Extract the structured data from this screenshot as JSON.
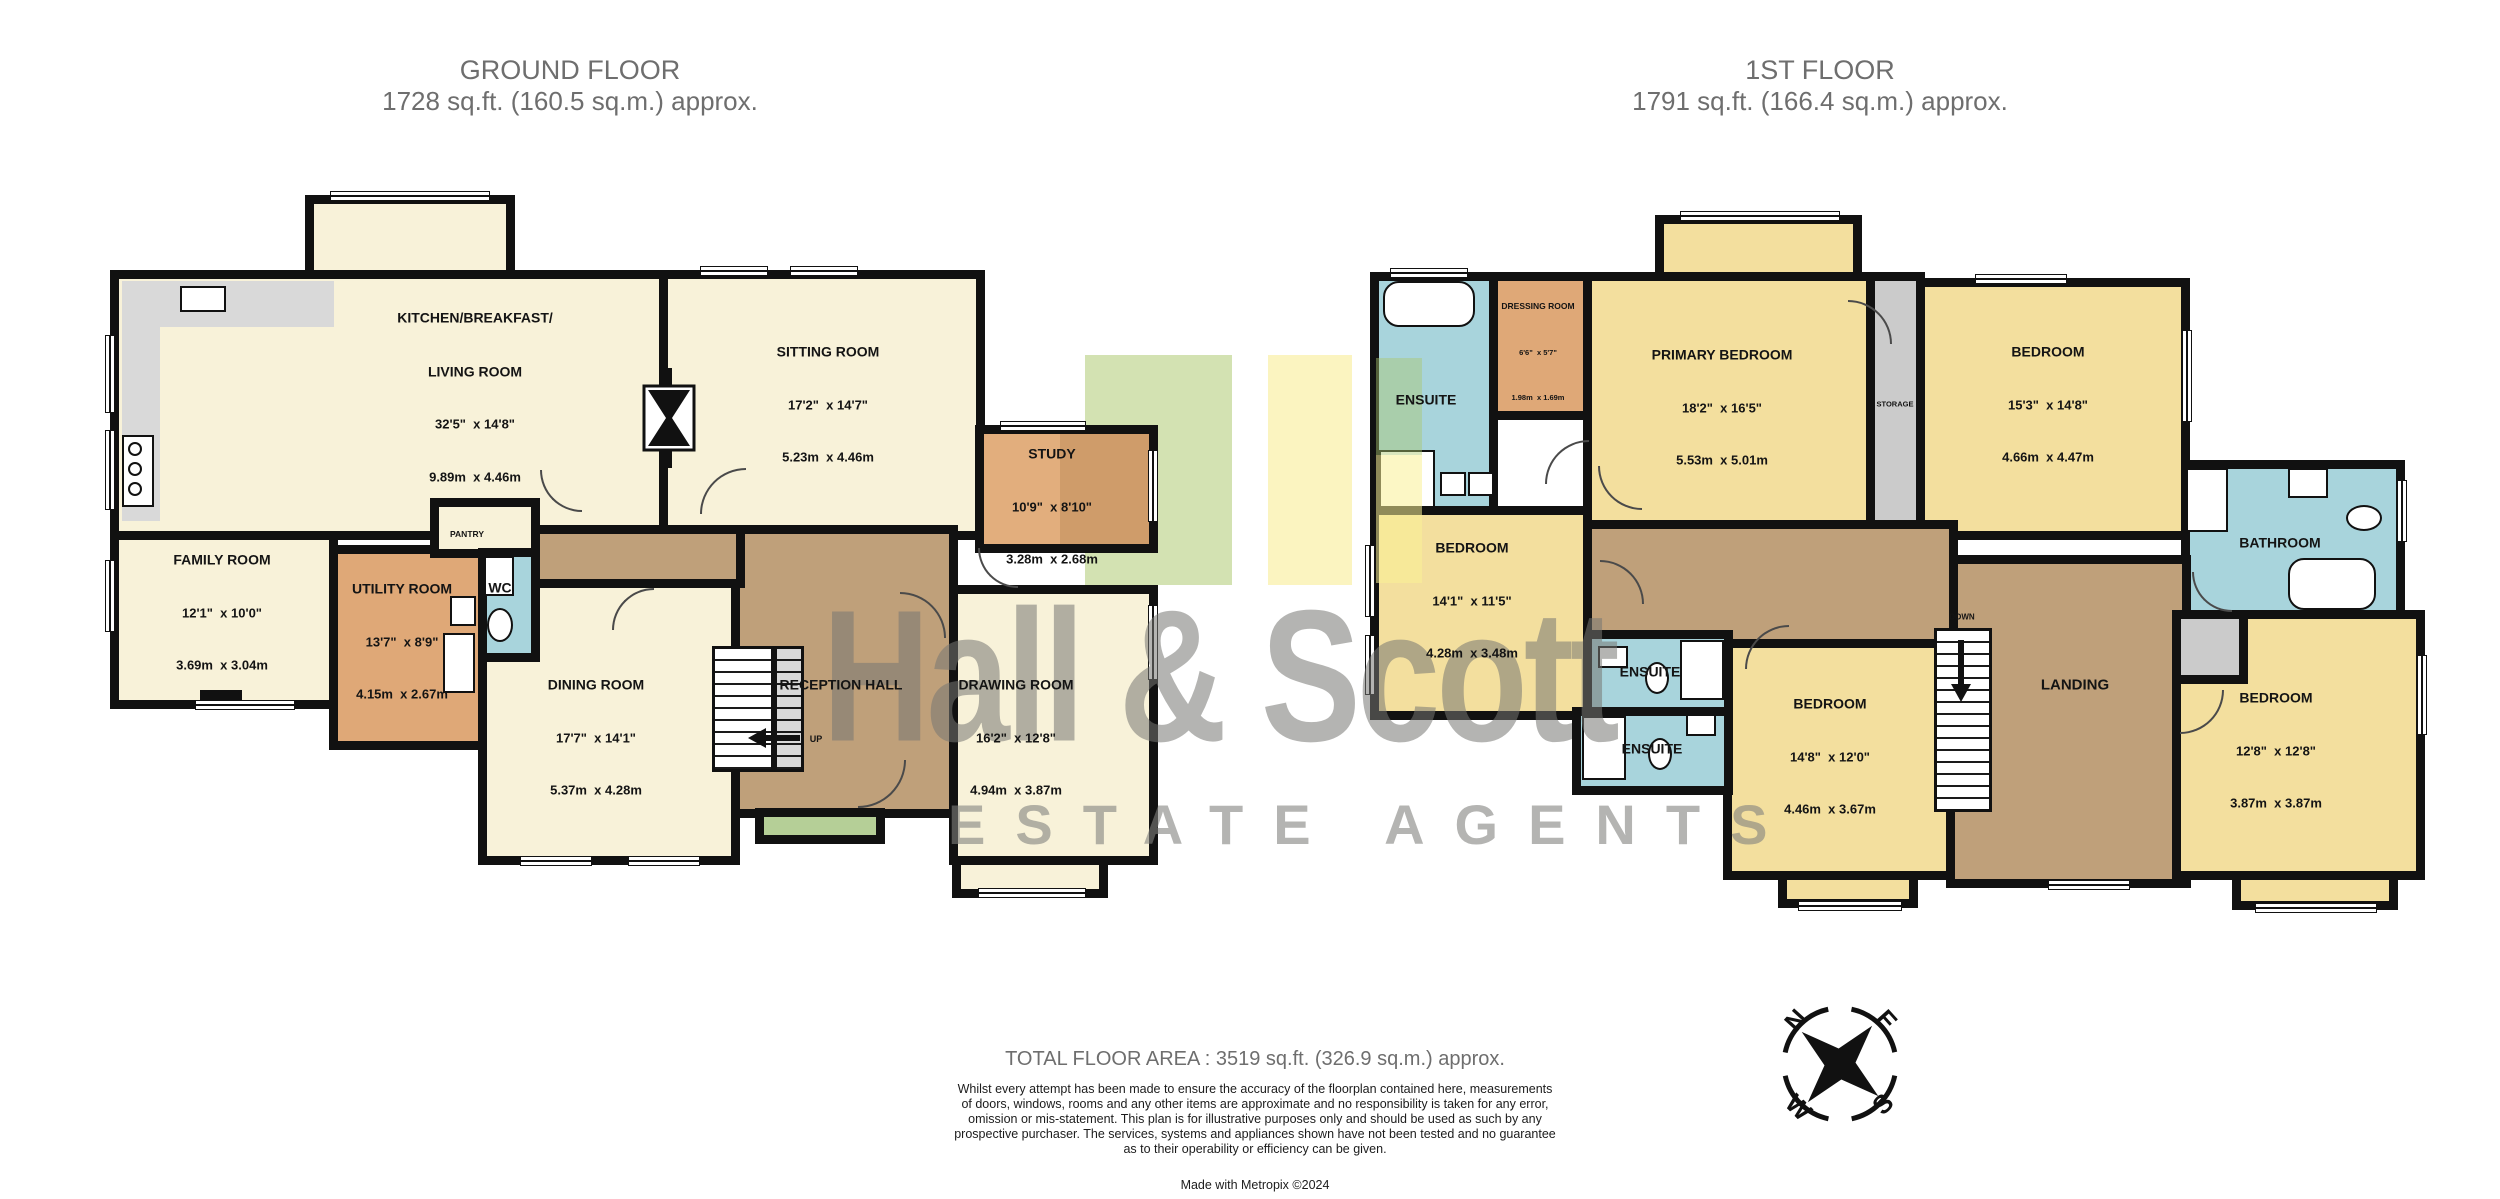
{
  "titles": {
    "ground": {
      "line1": "GROUND FLOOR",
      "line2": "1728 sq.ft. (160.5 sq.m.) approx."
    },
    "first": {
      "line1": "1ST FLOOR",
      "line2": "1791 sq.ft. (166.4 sq.m.) approx."
    }
  },
  "watermark": {
    "name": "Hall & Scott",
    "tagline": "ESTATE AGENTS"
  },
  "ground_floor": {
    "kitchen": {
      "name1": "KITCHEN/BREAKFAST/",
      "name2": "LIVING ROOM",
      "imperial": "32'5\"  x 14'8\"",
      "metric": "9.89m  x 4.46m"
    },
    "sitting": {
      "name": "SITTING ROOM",
      "imperial": "17'2\"  x 14'7\"",
      "metric": "5.23m  x 4.46m"
    },
    "study": {
      "name": "STUDY",
      "imperial": "10'9\"  x 8'10\"",
      "metric": "3.28m  x 2.68m"
    },
    "family": {
      "name": "FAMILY ROOM",
      "imperial": "12'1\"  x 10'0\"",
      "metric": "3.69m  x 3.04m"
    },
    "utility": {
      "name": "UTILITY ROOM",
      "imperial": "13'7\"  x 8'9\"",
      "metric": "4.15m  x 2.67m"
    },
    "dining": {
      "name": "DINING ROOM",
      "imperial": "17'7\"  x 14'1\"",
      "metric": "5.37m  x 4.28m"
    },
    "drawing": {
      "name": "DRAWING ROOM",
      "imperial": "16'2\"  x 12'8\"",
      "metric": "4.94m  x 3.87m"
    },
    "reception": {
      "name": "RECEPTION HALL"
    },
    "pantry": {
      "name": "PANTRY"
    },
    "wc": {
      "name": "WC"
    },
    "stairs": {
      "label": "UP"
    }
  },
  "first_floor": {
    "ensuite_primary": {
      "name": "ENSUITE"
    },
    "dressing": {
      "name": "DRESSING ROOM",
      "imperial": "6'6\"  x 5'7\"",
      "metric": "1.98m  x 1.69m"
    },
    "primary": {
      "name": "PRIMARY BEDROOM",
      "imperial": "18'2\"  x 16'5\"",
      "metric": "5.53m  x 5.01m"
    },
    "storage": {
      "name": "STORAGE"
    },
    "bedroom_top_right": {
      "name": "BEDROOM",
      "imperial": "15'3\"  x 14'8\"",
      "metric": "4.66m  x 4.47m"
    },
    "bedroom_mid_left": {
      "name": "BEDROOM",
      "imperial": "14'1\"  x 11'5\"",
      "metric": "4.28m  x 3.48m"
    },
    "ensuite_a": {
      "name": "ENSUITE"
    },
    "ensuite_b": {
      "name": "ENSUITE"
    },
    "bedroom_middle": {
      "name": "BEDROOM",
      "imperial": "14'8\"  x 12'0\"",
      "metric": "4.46m  x 3.67m"
    },
    "landing": {
      "name": "LANDING"
    },
    "bathroom": {
      "name": "BATHROOM"
    },
    "bedroom_bottom_right": {
      "name": "BEDROOM",
      "imperial": "12'8\"  x 12'8\"",
      "metric": "3.87m  x 3.87m"
    },
    "stairs": {
      "label": "DOWN"
    }
  },
  "footer": {
    "total": "TOTAL FLOOR AREA : 3519 sq.ft. (326.9 sq.m.) approx.",
    "disclaimer": [
      "Whilst every attempt has been made to ensure the accuracy of the floorplan contained here, measurements",
      "of doors, windows, rooms and any other items are approximate and no responsibility is taken for any error,",
      "omission or mis-statement. This plan is for illustrative purposes only and should be used as such by any",
      "prospective purchaser. The services, systems and appliances shown have not been tested and no guarantee",
      "as to their operability or efficiency can be given."
    ],
    "credit": "Made with Metropix ©2024"
  },
  "compass": {
    "n": "N",
    "e": "E",
    "s": "S",
    "w": "W"
  },
  "palette": {
    "cream": "#f8f2d9",
    "bedroom_yellow": "#f3df9e",
    "orange": "#dfa877",
    "hall_brown": "#bfa07a",
    "bath_blue": "#a8d4dc",
    "grey": "#cbcbcb",
    "porch_green": "#b5cf97",
    "wall": "#111111",
    "watermark_grey": "#aaaaa7"
  }
}
